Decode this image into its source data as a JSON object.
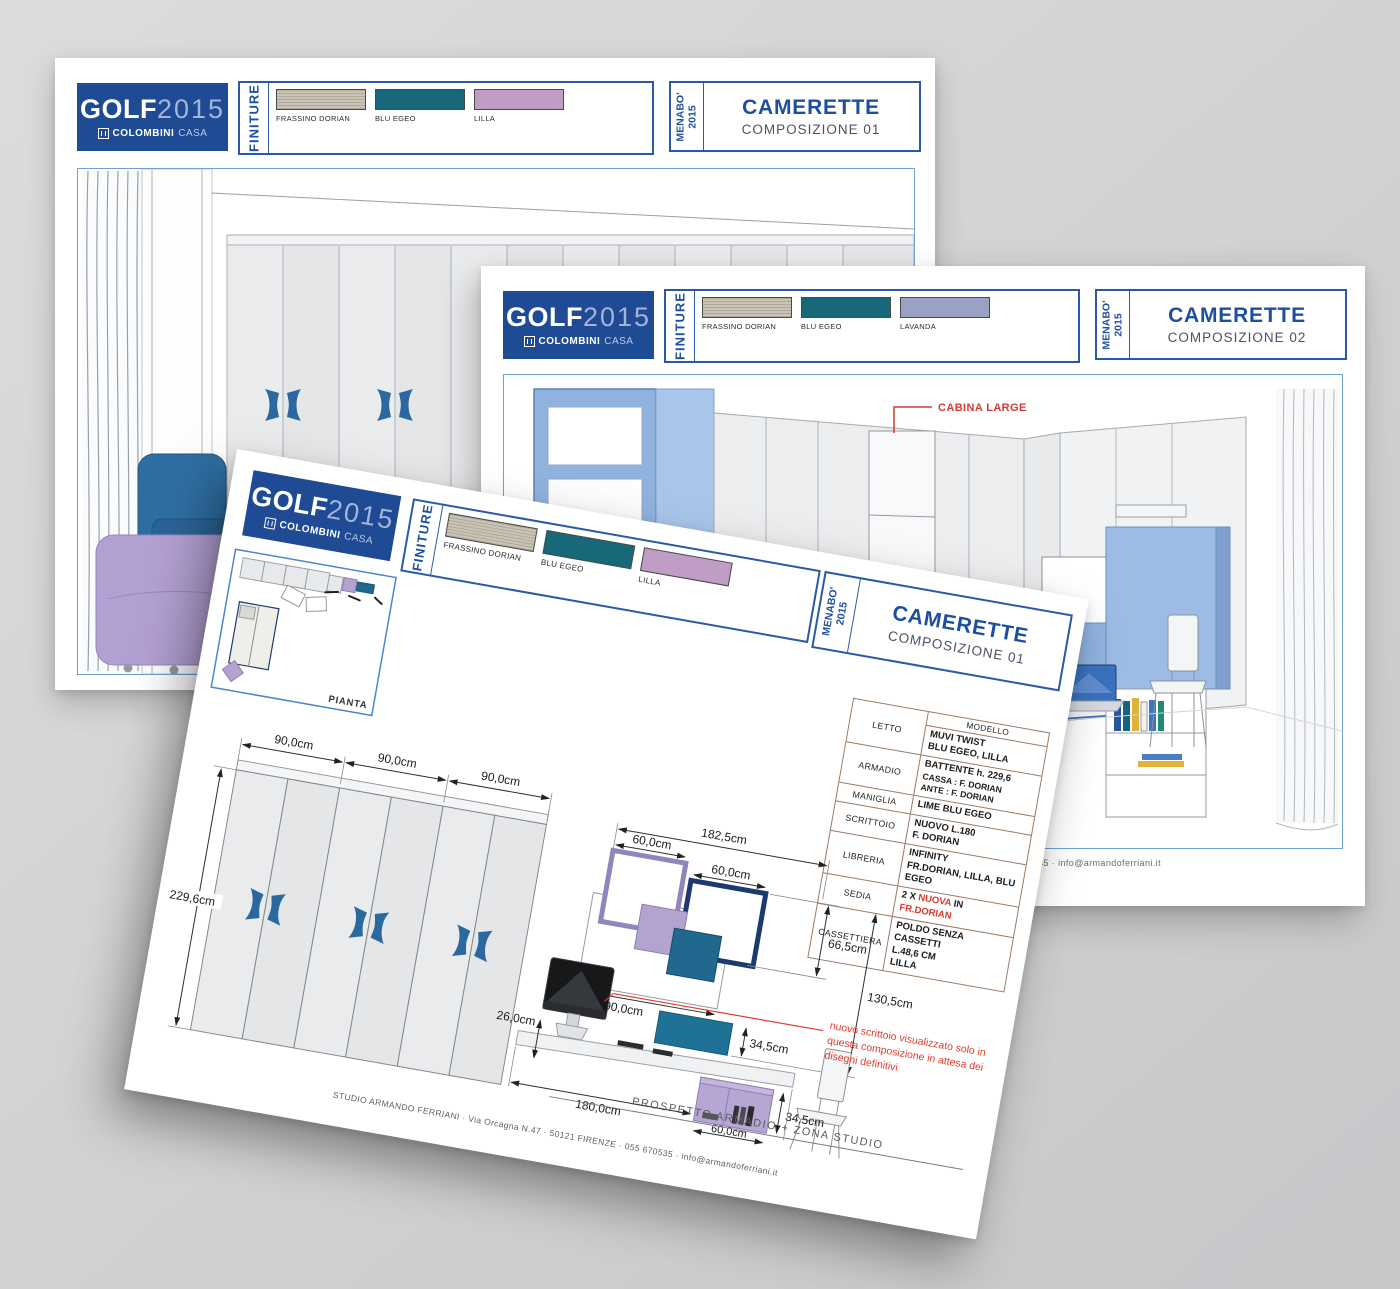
{
  "colors": {
    "logo_blue": "#1e4b94",
    "logo_year_blue": "#a2b4da",
    "title_blue": "#1d4f9e",
    "subtitle_gray": "#4c5264",
    "header_border_blue": "#2a59a5",
    "drawing_border_blue": "#6fa0d6",
    "annotation_red": "#d23b30",
    "table_border_brown": "#9b7a63",
    "frassino_dorian": "#cac4b6",
    "blu_egeo": "#176879",
    "lilla": "#c09dc4",
    "lavanda": "#99a1c4",
    "handle_blue": "#2b689f"
  },
  "sheets": [
    {
      "logo": {
        "brand": "GOLF",
        "year": "2015",
        "company": "COLOMBINI",
        "company2": "CASA"
      },
      "finiture_label": "FINITURE",
      "swatches": [
        {
          "name": "FRASSINO DORIAN",
          "color": "#cac4b6"
        },
        {
          "name": "BLU EGEO",
          "color": "#176879"
        },
        {
          "name": "LILLA",
          "color": "#c09dc4"
        }
      ],
      "menabo_line1": "MENABO'",
      "menabo_line2": "2015",
      "title": "CAMERETTE",
      "subtitle": "COMPOSIZIONE 01"
    },
    {
      "logo": {
        "brand": "GOLF",
        "year": "2015",
        "company": "COLOMBINI",
        "company2": "CASA"
      },
      "finiture_label": "FINITURE",
      "swatches": [
        {
          "name": "FRASSINO DORIAN",
          "color": "#cac4b6"
        },
        {
          "name": "BLU EGEO",
          "color": "#176879"
        },
        {
          "name": "LAVANDA",
          "color": "#99a1c4"
        }
      ],
      "menabo_line1": "MENABO'",
      "menabo_line2": "2015",
      "title": "CAMERETTE",
      "subtitle": "COMPOSIZIONE 02",
      "annotation": "CABINA LARGE",
      "footer": "STUDIO ARMANDO FERRIANI · Via Orcagna N.47 · 50121 FIRENZE · 055 670535 · info@armandoferriani.it"
    },
    {
      "logo": {
        "brand": "GOLF",
        "year": "2015",
        "company": "COLOMBINI",
        "company2": "CASA"
      },
      "finiture_label": "FINITURE",
      "swatches": [
        {
          "name": "FRASSINO DORIAN",
          "color": "#cac4b6"
        },
        {
          "name": "BLU EGEO",
          "color": "#176879"
        },
        {
          "name": "LILLA",
          "color": "#c09dc4"
        }
      ],
      "menabo_line1": "MENABO'",
      "menabo_line2": "2015",
      "title": "CAMERETTE",
      "subtitle": "COMPOSIZIONE 01",
      "pianta_label": "PIANTA",
      "table": {
        "col2_header": "MODELLO",
        "rows": [
          {
            "label": "LETTO",
            "lines": [
              "MUVI TWIST",
              "BLU EGEO, LILLA"
            ]
          },
          {
            "label": "ARMADIO",
            "lines": [
              "BATTENTE  h. 229,6",
              "CASSA : F. DORIAN",
              "ANTE : F. DORIAN"
            ]
          },
          {
            "label": "MANIGLIA",
            "lines": [
              "LIME BLU EGEO"
            ]
          },
          {
            "label": "SCRITTOIO",
            "lines": [
              "NUOVO L.180",
              "F. DORIAN"
            ]
          },
          {
            "label": "LIBRERIA",
            "lines": [
              "INFINITY",
              "FR.DORIAN, LILLA, BLU",
              "EGEO"
            ]
          },
          {
            "label": "SEDIA",
            "parts": {
              "p1": "2 X ",
              "red1": "NUOVA",
              "p2": " IN ",
              "red2": "FR.DORIAN"
            }
          },
          {
            "label": "CASSETTIERA",
            "lines": [
              "POLDO SENZA CASSETTI",
              "L.48,6 CM",
              "LILLA"
            ]
          }
        ]
      },
      "dims": {
        "wardrobe_w1": "90,0cm",
        "wardrobe_w2": "90,0cm",
        "wardrobe_w3": "90,0cm",
        "wardrobe_h": "229,6cm",
        "shelf_total_w": "182,5cm",
        "shelf_sq1": "60,0cm",
        "shelf_sq2": "60,0cm",
        "shelf_h1": "66,5cm",
        "shelf_h2": "130,5cm",
        "shelf_row_w": "90,0cm",
        "shelf_teal_h": "34,5cm",
        "desk_thickness": "26,0cm",
        "cabinet_h": "34,5cm",
        "cabinet_w": "60,0cm",
        "desk_w": "180,0cm"
      },
      "red_note_lines": [
        "nuovo scrittoio visualizzato solo in",
        "questa composizione in attesa dei",
        "disegni definitivi"
      ],
      "caption": "PROSPETTO ARMADIO + ZONA STUDIO",
      "footer": "STUDIO ARMANDO FERRIANI · Via Orcagna N.47 · 50121 FIRENZE · 055 670535 · info@armandoferriani.it"
    }
  ]
}
